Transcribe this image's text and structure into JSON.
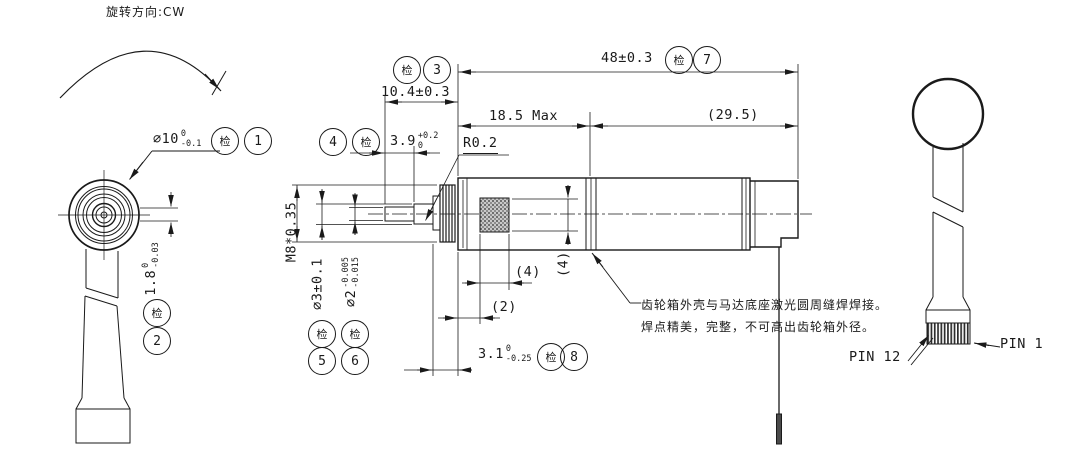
{
  "drawing": {
    "rotation_note": "旋转方向:CW",
    "inspection_symbol": "检",
    "dims": {
      "dia10": {
        "main": "∅10",
        "sup": "0",
        "sub": "-0.1",
        "balloon": "1"
      },
      "flat18": {
        "main": "1.8",
        "sup": "0",
        "sub": "-0.03",
        "balloon": "2"
      },
      "len104": {
        "text": "10.4±0.3",
        "balloon": "3"
      },
      "len39": {
        "main": "3.9",
        "sup": "+0.2",
        "sub": "0",
        "balloon": "4"
      },
      "radius": {
        "text": "R0.2"
      },
      "len185": {
        "text": "18.5 Max"
      },
      "len295": {
        "text": "(29.5)"
      },
      "len48": {
        "text": "48±0.3",
        "balloon": "7"
      },
      "thread": {
        "text": "M8*0.35"
      },
      "dia3": {
        "text": "∅3±0.1",
        "balloon": "5"
      },
      "dia2": {
        "main": "∅2",
        "sup": "-0.005",
        "sub": "-0.015",
        "balloon": "6"
      },
      "qr_w": {
        "text": "(4)"
      },
      "qr_h": {
        "text": "(4)"
      },
      "off2": {
        "text": "(2)"
      },
      "len31": {
        "main": "3.1",
        "sup": "0",
        "sub": "-0.25",
        "balloon": "8"
      }
    },
    "weld_note": {
      "line1": "齿轮箱外壳与马达底座激光圆周缝焊焊接。",
      "line2": "焊点精美，完整，不可高出齿轮箱外径。"
    },
    "pins": {
      "pin12": "PIN 12",
      "pin1": "PIN 1"
    }
  }
}
